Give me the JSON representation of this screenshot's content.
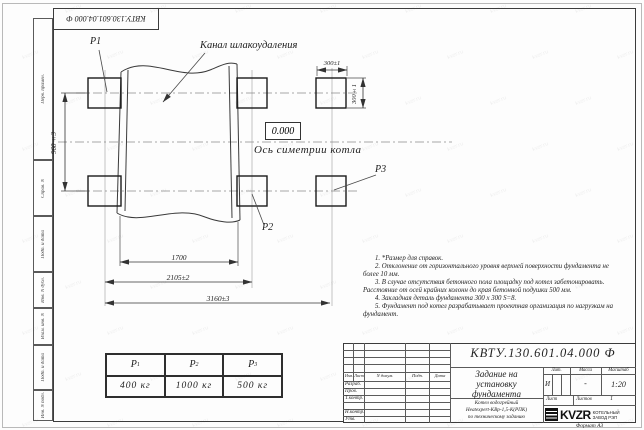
{
  "doc_number": "КВТУ.130.601.04.000 Ф",
  "frame": {
    "left_labels": [
      "Перв. примен.",
      "Справ. N",
      "Подп. и дата",
      "Инв. N дубл.",
      "Взам. инв. N",
      "Подп. и дата",
      "Инв. N подл."
    ],
    "format_label": "Формат А3"
  },
  "drawing": {
    "labels": {
      "channel": "Канал шлакоудаления",
      "axis": "Ось симетрии котла",
      "elevation": "0.000",
      "p1": "P1",
      "p2": "P2",
      "p3": "P3"
    },
    "dimensions": {
      "overall": "3160±3",
      "mid": "2105±2",
      "inner": "1700",
      "height": "960±3",
      "pad_w": "300±1",
      "pad_h": "300±1"
    }
  },
  "notes": [
    "1. *Размер для справок.",
    "2. Отклонение от горизонтального уровня верхней поверхности фундамента не более 10 мм.",
    "3. В случае отсутствия бетонного пола площадку под котел забетонировать. Расстояние от осей крайних колонн до края бетонной подушки 500 мм.",
    "4. Закладная деталь фундамента  300 x 300  S=8.",
    "5. Фундамент под котел разрабатывает проектная организация по нагрузкам на фундамент."
  ],
  "load_table": {
    "columns": [
      {
        "name": "P",
        "sub": "1",
        "value": "400 кг"
      },
      {
        "name": "P",
        "sub": "2",
        "value": "1000 кг"
      },
      {
        "name": "P",
        "sub": "3",
        "value": "500 кг"
      }
    ]
  },
  "title_block": {
    "title_lines": [
      "Задание на",
      "установку",
      "фундамента"
    ],
    "subtitle_lines": [
      "Котел водогрейный",
      "Heatexpert-КВр-1,5-К(РПК)",
      "по техническому заданию"
    ],
    "rev_header": [
      "Изм.",
      "Лист",
      "N докум.",
      "Подп.",
      "Дата"
    ],
    "sig_labels": [
      "Разраб.",
      "Пров.",
      "Т.контр.",
      "Н.контр.",
      "Утв."
    ],
    "lit_label": "Лит.",
    "lit_value": "И",
    "mass_label": "Масса",
    "mass_value": "-",
    "scale_label": "Масштаб",
    "scale_value": "1:20",
    "sheet_label": "Лист",
    "sheets_label": "Листов",
    "sheets_value": "1",
    "logo_word": "KVZR",
    "logo_caption_lines": [
      "КОТЕЛЬНЫЙ",
      "ЗАВОД РЭП"
    ]
  },
  "watermark": {
    "text": "kvzr.ru"
  }
}
